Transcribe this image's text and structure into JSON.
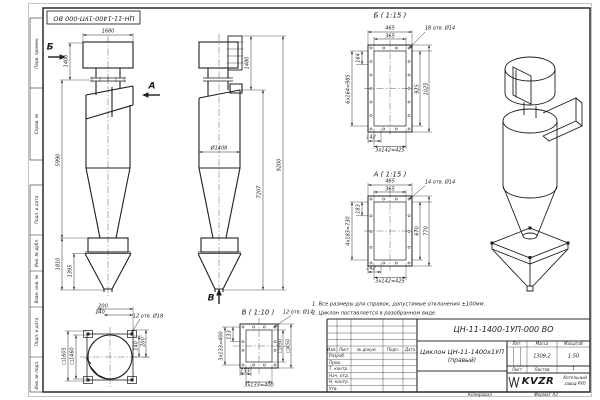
{
  "sheet": {
    "stamp_rotated": "ЦН-11-1400-1УП-000 ВО",
    "margin_labels": [
      "Перв. примен.",
      "Справ. №",
      "Подп. и дата",
      "Инв. № дубл.",
      "Взам. инв. №",
      "Подп. и дата",
      "Инв. № подл."
    ],
    "footer": {
      "copied": "Копировал",
      "format": "Формат А3"
    }
  },
  "notes": {
    "line1": "1. Все размеры для справок, допустимые отклонения ±100мм.",
    "line2": "2. Циклон поставляется в разобранном виде."
  },
  "views": {
    "front": {
      "w1680": "1680",
      "h1400": "1400",
      "h5990": "5990",
      "h1810": "1810",
      "h1395": "1395",
      "arrow_b": "Б",
      "arrow_a": "А"
    },
    "side": {
      "d1408": "Ø1408",
      "h1480": "1480",
      "h7207": "7207",
      "h9200": "9200",
      "arrow_v": "В"
    },
    "section_b": {
      "title": "Б ( 1:15 )",
      "w465": "465",
      "w365": "365",
      "holes": "18 отв. Ø14",
      "s164": "164",
      "chain_v": "6х164=985",
      "h925": "925",
      "h1025": "1025",
      "s142": "142",
      "chain_h": "3х142=425"
    },
    "section_a": {
      "title": "А ( 1:15 )",
      "w465": "465",
      "w365": "365",
      "holes": "14 отв. Ø14",
      "s183": "183",
      "chain_v": "4х183=730",
      "h670": "670",
      "h770": "770",
      "s142": "142",
      "chain_h": "3х142=425"
    },
    "plan": {
      "w200": "200",
      "w140": "140",
      "holes": "12 отв. Ø18",
      "sq1605": "□1605",
      "sq1460": "□1460",
      "r140": "140",
      "r200": "200"
    },
    "section_v": {
      "title": "В ( 1:10 )",
      "holes": "12 отв. Ø14",
      "s133": "133",
      "chain_v": "3х133=400",
      "sq350": "□350",
      "sq450": "□450",
      "b133": "133",
      "chain_h": "3х133=400"
    }
  },
  "title_block": {
    "doc_number": "ЦН-11-1400-1УП-000 ВО",
    "name1": "Циклон ЦН-11-1400х1УП",
    "name2": "(правый)",
    "rev_cols": {
      "izm": "Изм.",
      "list": "Лист",
      "doc": "№ докум.",
      "podp": "Подп.",
      "data": "Дата"
    },
    "rows": [
      "Разраб.",
      "Пров.",
      "Т. контр.",
      "Нач. отд.",
      "Н. контр.",
      "Утв."
    ],
    "lit": "Лит.",
    "mass": "Масса",
    "scale": "Масштаб",
    "mass_value": "1309,2",
    "scale_value": "1:50",
    "sheet": "Лист",
    "sheets": "Листов",
    "sheets_value": "1",
    "logo": "KVZR",
    "org1": "Котельный",
    "org2": "завод РУП"
  }
}
